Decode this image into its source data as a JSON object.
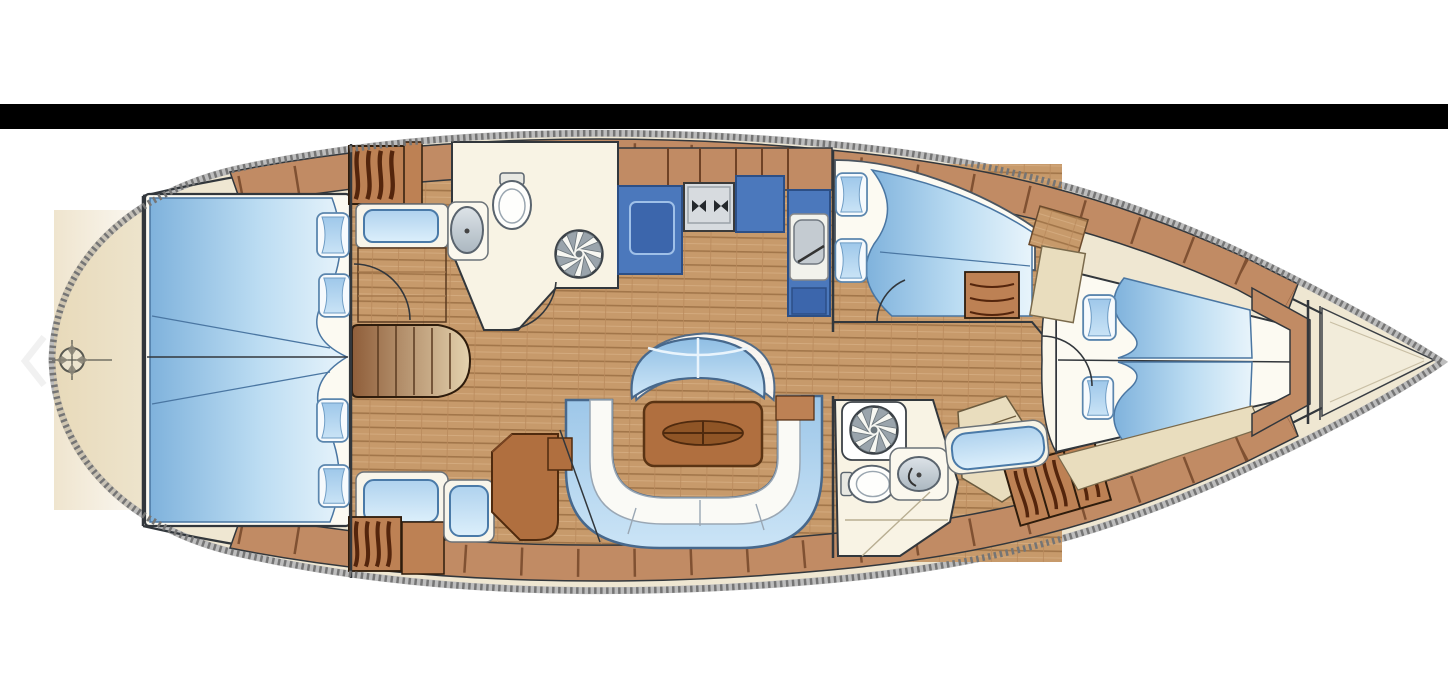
{
  "viewer": {
    "prev_icon": "chevron-left-icon"
  },
  "colors": {
    "background": "#FFFFFF",
    "letterbox_bar": "#000000",
    "hull_deck_cream": "#EFE7D2",
    "stern_deck_shade": "#E2CFA6",
    "rope_edge_light": "#BDBDBD",
    "rope_edge_dark": "#757575",
    "outline_dark": "#32373C",
    "cabinet_wood": "#C18B64",
    "cabinet_divider": "#6F4226",
    "louver_slat": "#54250C",
    "floor_wood": "#C79A6B",
    "floor_plank_line": "#A2764A",
    "duvet_blue_dark": "#7FB2DC",
    "duvet_blue_light": "#E8F4FB",
    "pillow_blue": "#9FC8EA",
    "upholstery_blue": "#AFD2EE",
    "settee_blue": "#9CC6E8",
    "settee_outline": "#47688C",
    "galley_blue": "#4B78BC",
    "galley_blue_dark": "#3C66AC",
    "table_wood": "#B06F3F",
    "table_wood_dark": "#4F2A0E",
    "bathroom_floor": "#F8F3E4",
    "fixture_gray": "#C4CBD1",
    "chevron_white": "#F1F1F1"
  },
  "floor_plan": {
    "type": "sailing-yacht-interior-layout",
    "orientation": "bow-right",
    "features": [
      "aft-owner-cabin-double-berth",
      "wardrobe-louver-lockers",
      "vanity-seat",
      "companionway-steps",
      "corridor-bench",
      "nav-seat",
      "chart-table",
      "port-heads-with-shower",
      "galley-sink-counter",
      "stove",
      "galley-counter",
      "galley-sink-unit",
      "salon-curved-bench",
      "salon-table",
      "salon-u-settee",
      "starboard-double-cabin",
      "chest-of-drawers",
      "starboard-heads-with-shower",
      "passage-bench",
      "hull-side-lockers",
      "forward-v-berth-cabin",
      "bow-anchor-locker",
      "stern-windlass-fitting"
    ]
  }
}
